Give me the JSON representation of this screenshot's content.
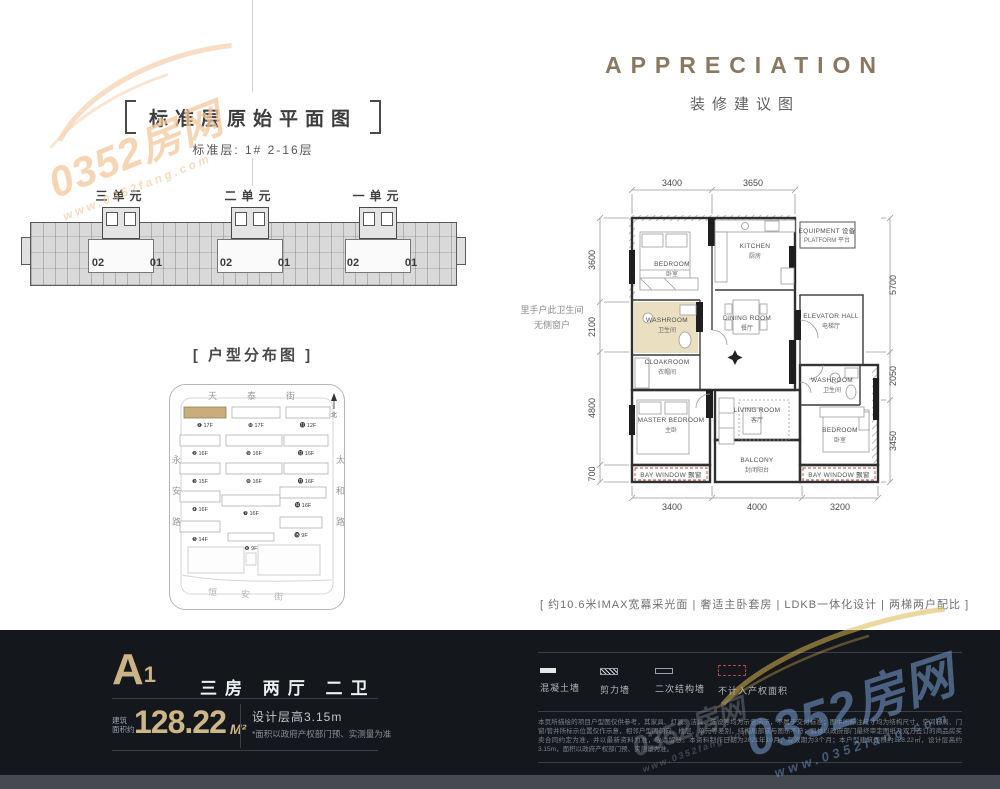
{
  "brand": {
    "name": "0352房网",
    "url": "www.0352fang.com"
  },
  "standard_plan": {
    "title": "标准层原始平面图",
    "subtitle": "标准层: 1#  2-16层",
    "units": [
      {
        "name": "三单元",
        "no_left": "02",
        "no_right": "01"
      },
      {
        "name": "二单元",
        "no_left": "02",
        "no_right": "01"
      },
      {
        "name": "一单元",
        "no_left": "02",
        "no_right": "01"
      }
    ]
  },
  "distribution": {
    "title": "[ 户型分布图 ]",
    "streets": {
      "top": "天泰街",
      "left": "永安路",
      "right": "太和路",
      "bottom": "恒安街"
    },
    "north_label": "北",
    "building_markers": [
      "❶ 17F",
      "❿ 17F",
      "⓫ 12F",
      "❷ 16F",
      "❾ 16F",
      "⓬ 16F",
      "❸ 15F",
      "❽ 16F",
      "⓭ 16F",
      "❹ 16F",
      "❼ 16F",
      "⓮ 16F",
      "❺ 14F",
      "❻ 9F",
      "⓯ 9F"
    ]
  },
  "suggestion": {
    "title": "APPRECIATION",
    "subtitle": "装修建议图",
    "side_note_line1": "里手户此卫生间",
    "side_note_line2": "无侧窗户",
    "dims": {
      "top": [
        "3400",
        "3650"
      ],
      "bottom": [
        "3400",
        "4000",
        "3200"
      ],
      "left": [
        "3600",
        "2100",
        "4800",
        "700"
      ],
      "right": [
        "5700",
        "2050",
        "3450"
      ]
    },
    "rooms": {
      "bedroom_top": {
        "l1": "BEDROOM",
        "l2": "卧室"
      },
      "kitchen": {
        "l1": "KITCHEN",
        "l2": "厨房"
      },
      "equipment": {
        "l1": "EQUIPMENT 设备",
        "l2": "PLATFORM 平台"
      },
      "dining": {
        "l1": "DINING ROOM",
        "l2": "餐厅"
      },
      "elevator": {
        "l1": "ELEVATOR HALL",
        "l2": "电梯厅"
      },
      "washroom_main": {
        "l1": "WASHROOM",
        "l2": "卫生间"
      },
      "cloakroom": {
        "l1": "CLOAKROOM",
        "l2": "衣帽间"
      },
      "washroom_right": {
        "l1": "WASHROOM",
        "l2": "卫生间"
      },
      "master": {
        "l1": "MASTER BEDROOM",
        "l2": "主卧"
      },
      "living": {
        "l1": "LIVING ROOM",
        "l2": "客厅"
      },
      "balcony": {
        "l1": "BALCONY",
        "l2": "封闭阳台"
      },
      "bedroom_right": {
        "l1": "BEDROOM",
        "l2": "卧室"
      },
      "bay_left": {
        "l1": "BAY WINDOW 飘窗"
      },
      "bay_right": {
        "l1": "BAY WINDOW 飘窗"
      }
    },
    "tagline": "[ 约10.6米IMAX宽幕采光面  |  奢适主卧套房  |  LDKB一体化设计  |  两梯两户配比 ]"
  },
  "footer": {
    "unit_code": "A",
    "unit_code_sub": "1",
    "layout": "三房  两厅  二卫",
    "area_label_l1": "建筑",
    "area_label_l2": "面积约",
    "area_value": "128.22",
    "area_unit": "M²",
    "height_note": "设计层高3.15m",
    "accuracy_note": "*面积以政府产权部门预、实测量为准",
    "legend": [
      {
        "label": "混凝土墙"
      },
      {
        "label": "剪力墙"
      },
      {
        "label": "二次结构墙"
      },
      {
        "label": "不计入产权面积"
      }
    ],
    "fine_print": "本页所描绘的项目户型图仅供参考，其家具、灯具、洁具、陈设等均为示意演示，不属于交付标准；图中所标注尺寸均为结构尺寸，空间布局、门窗/管井所标示位置仅作示意，相邻户型因朝向、楼层、单元等差别，结构局部或与图示不符；具体以政府部门最终审定图纸及双方签订的商品房买卖合同约定为准，并以最新资料为准，敬请留意。本资料制作日期为2021年10月，有效期为3个月；本户型建筑面积约128.22㎡，设计层高约3.15m，面积以政府产权部门预、实测量为准。"
  },
  "colors": {
    "accent_gold": "#cbb387",
    "footer_bg": "#14171c",
    "highlight_tan": "#c9ae7d",
    "bay_red": "#c0493f"
  }
}
